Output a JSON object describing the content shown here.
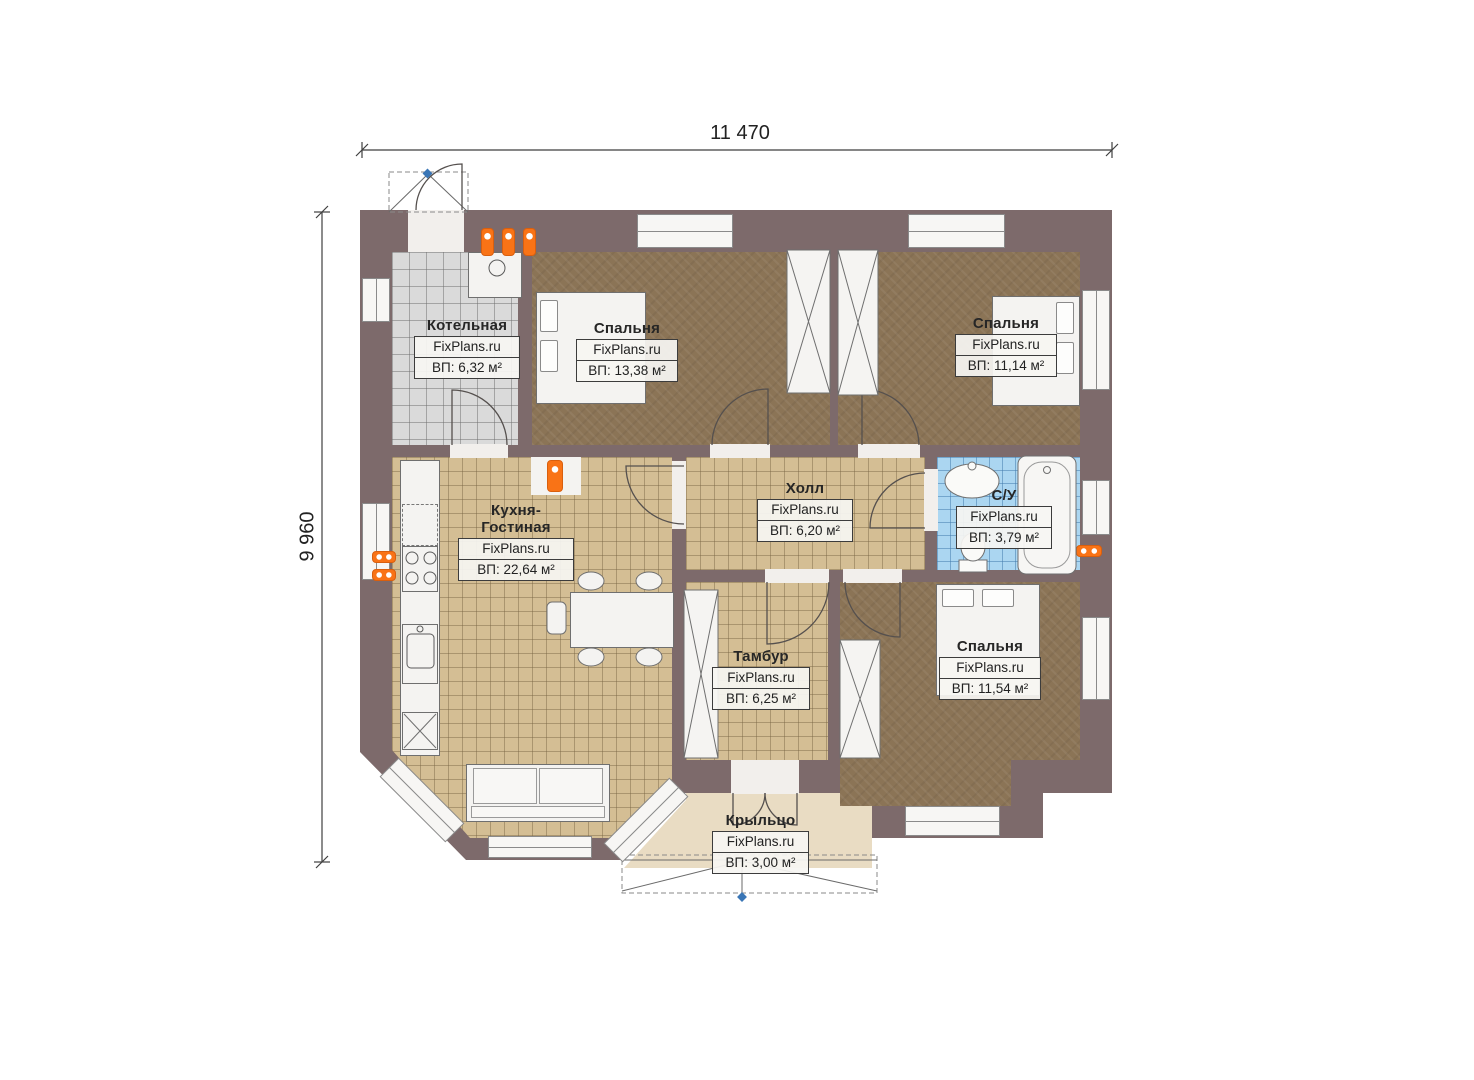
{
  "plan_title": "Floor plan",
  "dimensions": {
    "top": "11 470",
    "left": "9 960"
  },
  "watermark": "FixPlans.ru",
  "rooms": [
    {
      "id": "kotelnaya",
      "name": "Котельная",
      "area": "ВП: 6,32 м²",
      "floor": "gray-tile"
    },
    {
      "id": "spalnya-1",
      "name": "Спальня",
      "area": "ВП: 13,38 м²",
      "floor": "carpet"
    },
    {
      "id": "spalnya-2",
      "name": "Спальня",
      "area": "ВП: 11,14 м²",
      "floor": "carpet"
    },
    {
      "id": "kuhnya",
      "name": "Кухня-Гостиная",
      "area": "ВП: 22,64 м²",
      "floor": "tan-tile"
    },
    {
      "id": "holl",
      "name": "Холл",
      "area": "ВП: 6,20 м²",
      "floor": "tan-tile"
    },
    {
      "id": "su",
      "name": "С/У",
      "area": "ВП: 3,79 м²",
      "floor": "blue-tile"
    },
    {
      "id": "tambur",
      "name": "Тамбур",
      "area": "ВП: 6,25 м²",
      "floor": "tan-tile"
    },
    {
      "id": "spalnya-3",
      "name": "Спальня",
      "area": "ВП: 11,54 м²",
      "floor": "carpet"
    },
    {
      "id": "krylco",
      "name": "Крыльцо",
      "area": "ВП: 3,00 м²",
      "floor": "porch"
    }
  ],
  "colors": {
    "wall": "#7d6a6b",
    "carpet": "#8b7456",
    "tan_tile": "#d4be94",
    "gray_tile": "#dadada",
    "blue_tile": "#abd6f1",
    "porch": "#e9dcc3",
    "radiator": "#f97316",
    "marker_blue": "#3a76b6"
  }
}
